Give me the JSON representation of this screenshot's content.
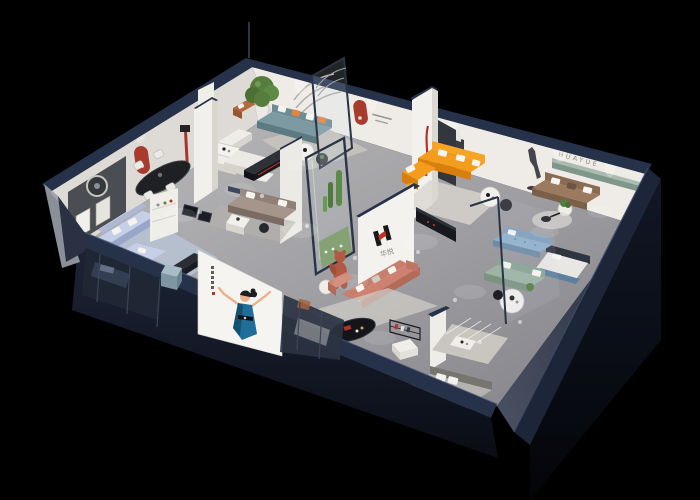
{
  "scene": {
    "brand": {
      "name_cn": "华悦",
      "wall_letters_en": "HUAYUE"
    },
    "palette": {
      "background": "#000000",
      "exterior_navy": "#26324a",
      "facade_dark": "#141b2b",
      "wall_white": "#efece7",
      "wall_dark_panel": "#4a4d52",
      "floor_gray": "#9e9da1",
      "arch_red": "#a63b2e",
      "brand_red": "#c13325",
      "brand_black": "#191919",
      "sofa_orange": "#f49d1c",
      "sofa_teal": "#7d9aa3",
      "sofa_coral": "#cd8170",
      "sofa_sage": "#9db4a4",
      "sofa_periwinkle": "#c5cfe8",
      "sofa_brown": "#9b7a60",
      "sofa_blue": "#8fb0cc",
      "sofa_taupe": "#a5958a",
      "armchair_tan": "#b06a3e",
      "rug_blue": "#b7c1d2",
      "rug_light": "#cfccc5",
      "plant_green": "#567d3e",
      "ledge_green": "#7f978b",
      "poster_white": "#f5f4f1",
      "dress_blue": "#1f6e99",
      "skin_tone": "#e9b28c",
      "table_black": "#141518",
      "bear_terracotta": "#b05a44"
    }
  }
}
